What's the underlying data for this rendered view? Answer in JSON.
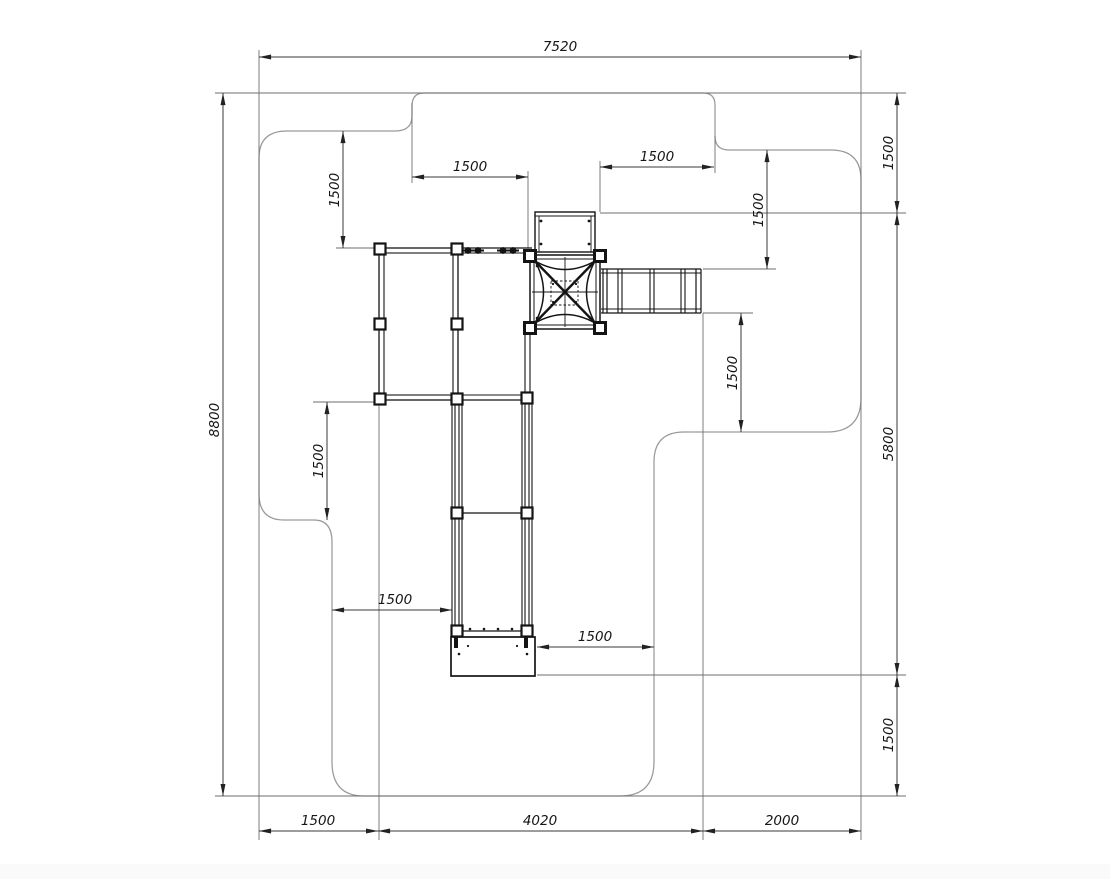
{
  "drawing": {
    "kind": "playground-equipment-plan-view-with-safety-zone",
    "colors": {
      "equipment_line": "#141414",
      "safety_zone_line": "#9a9a9a",
      "dimension_line": "#3a3a3a",
      "label_text": "#161616",
      "background": "#ffffff"
    }
  },
  "dims": {
    "overall_width": "7520",
    "overall_height": "8800",
    "right_top": "1500",
    "right_middle": "5800",
    "right_bottom": "1500",
    "bottom_left": "1500",
    "bottom_middle": "4020",
    "bottom_right": "2000",
    "top_left_vertical": "1500",
    "top_left_horizontal": "1500",
    "top_right_horizontal": "1500",
    "top_right_vertical": "1500",
    "mid_right_vertical": "1500",
    "mid_left_vertical": "1500",
    "mid_left_horizontal": "1500",
    "bottom_mid_horizontal": "1500"
  }
}
